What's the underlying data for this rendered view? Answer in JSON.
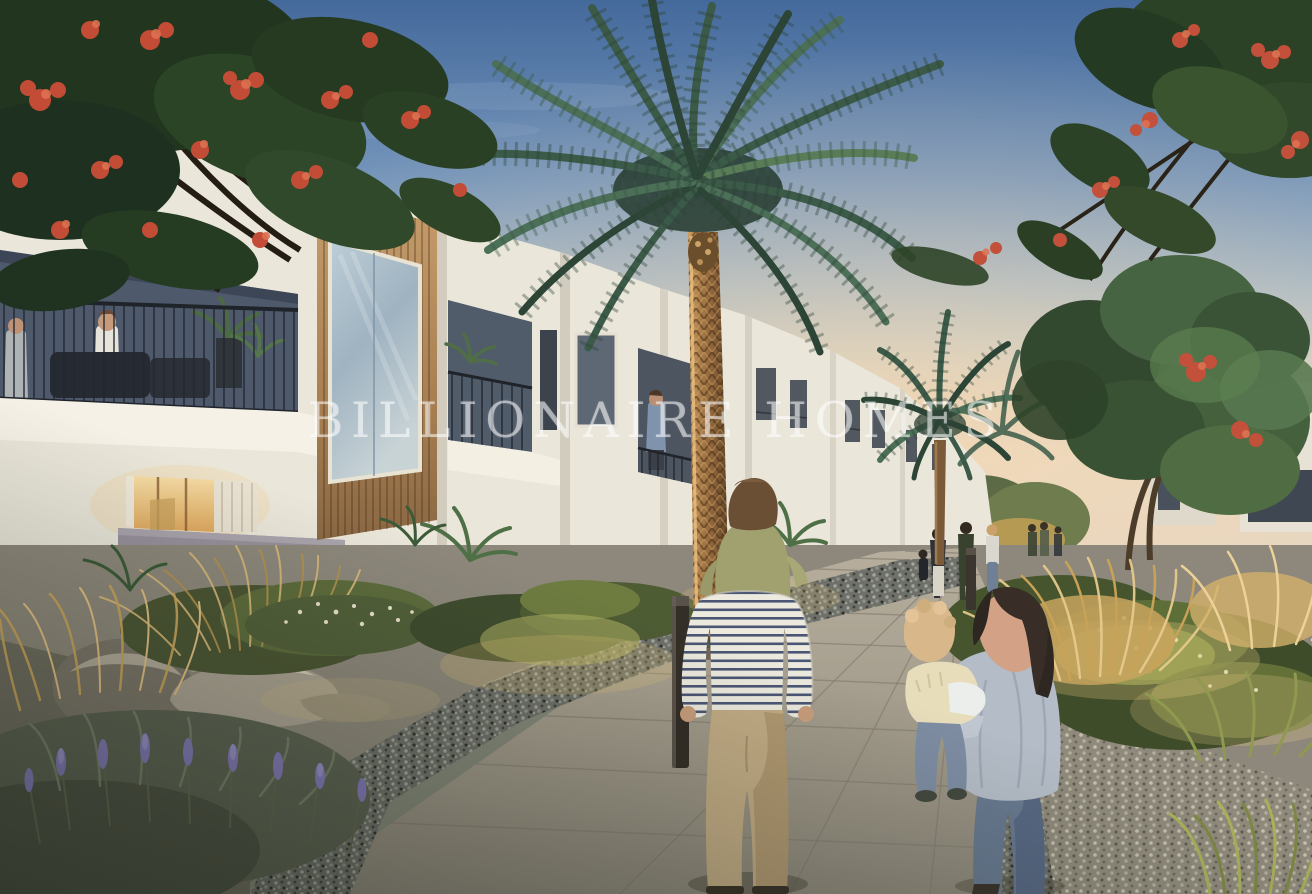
{
  "watermark": {
    "text": "BILLIONAIRE HOMES",
    "color": "rgba(255,255,255,0.52)"
  },
  "scene": {
    "description": "Twilight architectural render of a modern townhouse community walkway with palms, flowering trees and residents",
    "elements": [
      "sunset-sky",
      "flowering-tree-left",
      "flowering-tree-right",
      "date-palm-central",
      "secondary-palms",
      "leafy-tree-right",
      "townhouse-row",
      "wood-clad-facade",
      "balcony-with-residents",
      "lit-interior-window",
      "boundary-walls",
      "stone-walkway",
      "plank-decking",
      "gravel-beds",
      "boulders",
      "ornamental-grasses",
      "lavender-bed",
      "green-shrubs",
      "bollard-light",
      "father-with-child-on-shoulders",
      "mother-carrying-toddler",
      "distant-pedestrians"
    ]
  },
  "palette": {
    "sky_top": "#4a6f9f",
    "sky_horizon": "#e4d6c4",
    "house_white": "#efebe0",
    "wood_accent": "#bf9264",
    "palm_green": "#3b5a48",
    "flower_red": "#c24c36",
    "grass_gold": "#d0a960",
    "lavender": "#7f74b4",
    "path_stone": "#a49e8f",
    "stripe_navy": "#4b5674",
    "pants_khaki": "#c2ac85",
    "shirt_grey_blue": "#b4bcc7",
    "child_olive": "#a0a16e"
  }
}
